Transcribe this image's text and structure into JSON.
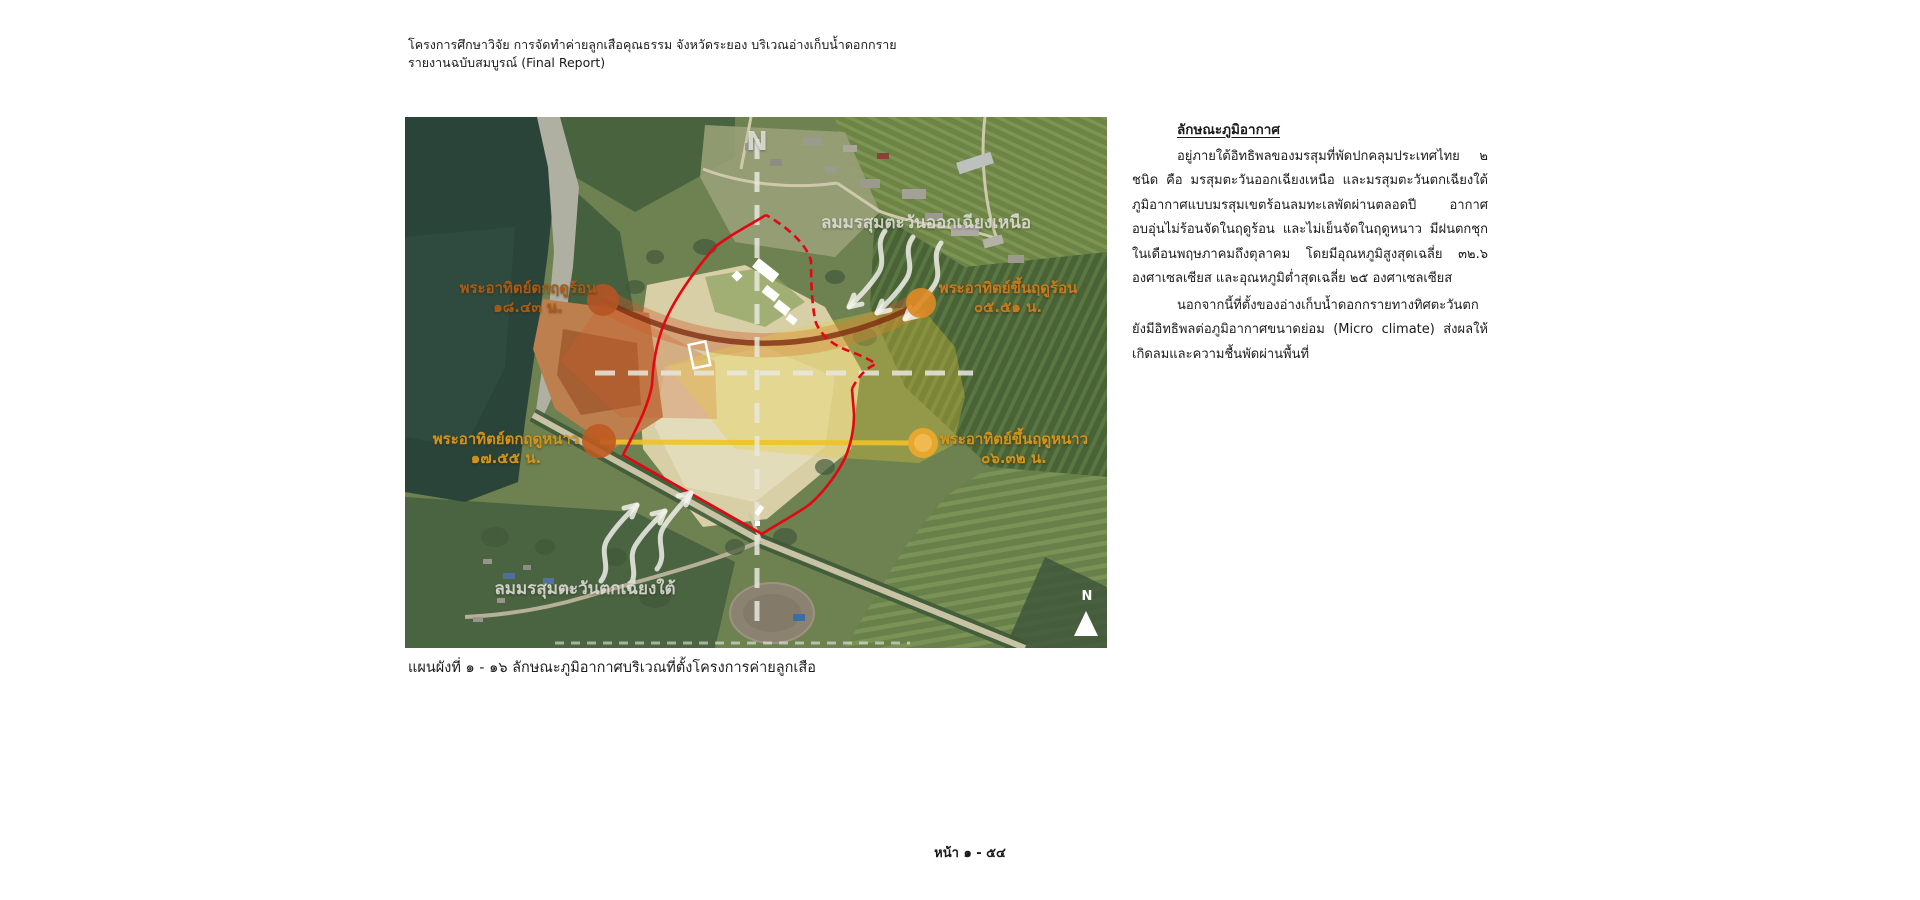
{
  "header": {
    "line1": "โครงการศึกษาวิจัย การจัดทำค่ายลูกเสือคุณธรรม จังหวัดระยอง บริเวณอ่างเก็บน้ำดอกกราย",
    "line2": "รายงานฉบับสมบูรณ์ (Final Report)"
  },
  "map": {
    "north_axis_label": "N",
    "compass_label": "N",
    "wind": {
      "northeast": "ลมมรสุมตะวันออกเฉียงเหนือ",
      "southwest": "ลมมรสุมตะวันตกเฉียงใต้"
    },
    "sun": {
      "summer_sunset": {
        "name": "พระอาทิตย์ตกฤดูร้อน",
        "time": "๑๘.๔๓ น."
      },
      "summer_sunrise": {
        "name": "พระอาทิตย์ขึ้นฤดูร้อน",
        "time": "๐๕.๕๑ น."
      },
      "winter_sunset": {
        "name": "พระอาทิตย์ตกฤดูหนาว",
        "time": "๑๗.๕๕ น."
      },
      "winter_sunrise": {
        "name": "พระอาทิตย์ขึ้นฤดูหนาว",
        "time": "๐๖.๓๒ น."
      }
    },
    "colors": {
      "site_boundary": "#e30613",
      "summer_sun_path": "#7e2d12",
      "winter_sun_path": "#eec227",
      "summer_label": "#a65c16",
      "winter_label": "#d2951c"
    }
  },
  "caption": "แผนผังที่ ๑ - ๑๖ ลักษณะภูมิอากาศบริเวณที่ตั้งโครงการค่ายลูกเสือ",
  "body": {
    "heading": "ลักษณะภูมิอากาศ",
    "paragraph1": "อยู่ภายใต้อิทธิพลของมรสุมที่พัดปกคลุมประเทศไทย ๒ ชนิด คือ มรสุมตะวันออกเฉียงเหนือ และมรสุมตะวันตกเฉียงใต้ ภูมิอากาศแบบมรสุมเขตร้อนลมทะเลพัดผ่านตลอดปี อากาศอบอุ่นไม่ร้อนจัดในฤดูร้อน และไม่เย็นจัดในฤดูหนาว มีฝนตกชุกในเดือนพฤษภาคมถึงตุลาคม โดยมีอุณหภูมิสูงสุดเฉลี่ย ๓๒.๖ องศาเซลเซียส และอุณหภูมิต่ำสุดเฉลี่ย ๒๕ องศาเซลเซียส",
    "paragraph2": "นอกจากนี้ที่ตั้งของอ่างเก็บน้ำดอกกรายทางทิศตะวันตกยังมีอิทธิพลต่อภูมิอากาศขนาดย่อม (Micro climate) ส่งผลให้เกิดลมและความชื้นพัดผ่านพื้นที่"
  },
  "footer": {
    "page_label": "หน้า ๑ - ๕๔"
  }
}
